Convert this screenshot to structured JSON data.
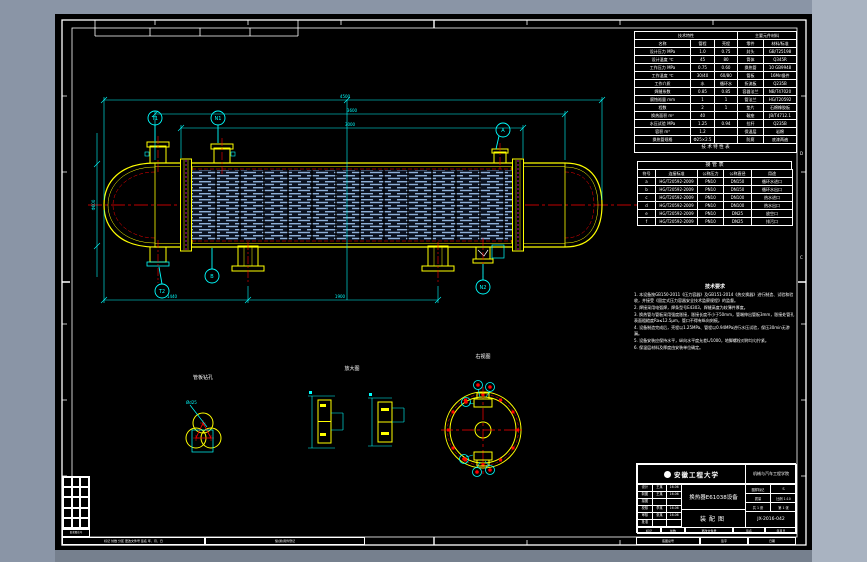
{
  "colors": {
    "background": "#8a95a6",
    "sheet": "#000000",
    "primary_line": "#ffff00",
    "dimension_line": "#00ffff",
    "centerline": "#ff0000",
    "frame_line": "#ffffff",
    "tube_hatch": "#8fb0d8",
    "gasket": "#ff00ff"
  },
  "balloons": [
    {
      "label": "T1"
    },
    {
      "label": "N1"
    },
    {
      "label": "A"
    },
    {
      "label": "B"
    },
    {
      "label": "T2"
    },
    {
      "label": "N2"
    }
  ],
  "dimensions": {
    "overall": "4500",
    "tangent": "3600",
    "tube_length": "3000",
    "saddle_span_a": "1440",
    "saddle_span_b": "1900",
    "diameter": "Φ600",
    "detail_leader": "Ød25"
  },
  "frame": {
    "zone_marks": [
      "D",
      "C"
    ]
  },
  "spec_table": {
    "group_left": "技术特性",
    "group_right": "主要元件材料",
    "headers": [
      "名称",
      "管程",
      "壳程",
      "零件",
      "材料/标准"
    ],
    "rows": [
      [
        "设计压力 MPa",
        "1.0",
        "0.75",
        "封头",
        "GB/T25198"
      ],
      [
        "设计温度 ℃",
        "45",
        "80",
        "筒体",
        "Q345R"
      ],
      [
        "工作压力 MPa",
        "0.75",
        "0.60",
        "换热管",
        "10 GB9948"
      ],
      [
        "工作温度 ℃",
        "30/40",
        "60/80",
        "管板",
        "16Mn锻件"
      ],
      [
        "工作介质",
        "水",
        "循环水",
        "折流板",
        "Q235B"
      ],
      [
        "焊缝系数",
        "0.85",
        "0.85",
        "容器法兰",
        "NB/T47020"
      ],
      [
        "腐蚀裕量 mm",
        "1",
        "1",
        "管法兰",
        "HG/T20592"
      ],
      [
        "程数",
        "2",
        "1",
        "垫片",
        "石棉橡胶板"
      ],
      [
        "换热面积 m²",
        "40",
        "",
        "鞍座",
        "JB/T4712.1"
      ],
      [
        "水压试验 MPa",
        "1.25",
        "0.94",
        "拉杆",
        "Q235B"
      ],
      [
        "容积 m³",
        "1.2",
        "",
        "保温层",
        "岩棉"
      ],
      [
        "换热管规格",
        "Φ25×2.5",
        "",
        "防腐",
        "底漆两遍"
      ]
    ],
    "footer": "技 术 特 性 表"
  },
  "nozzle_table": {
    "title": "接 管 表",
    "headers": [
      "符号",
      "连接标准",
      "公称压力",
      "公称直径",
      "用途"
    ],
    "rows": [
      [
        "a",
        "HG/T20592-2009",
        "PN10",
        "DN150",
        "循环水进口"
      ],
      [
        "b",
        "HG/T20592-2009",
        "PN10",
        "DN150",
        "循环水出口"
      ],
      [
        "c",
        "HG/T20592-2009",
        "PN10",
        "DN100",
        "热水进口"
      ],
      [
        "d",
        "HG/T20592-2009",
        "PN10",
        "DN100",
        "热水出口"
      ],
      [
        "e",
        "HG/T20592-2009",
        "PN10",
        "DN25",
        "放空口"
      ],
      [
        "f",
        "HG/T20592-2009",
        "PN10",
        "DN25",
        "排污口"
      ]
    ]
  },
  "notes": {
    "title": "技术要求",
    "lines": [
      "1. 本设备按GB150-2011《压力容器》及GB151-2014《热交换器》进行制造、试验和验收，并接受《固定式压力容器安全技术监察规程》的监督。",
      "2. 焊接采用电弧焊，焊条型号E4303，焊缝高度为较薄件厚度。",
      "3. 换热管与管板采用强度胀接，胀接长度不小于50mm，管端伸出管板3mm，胀接处管孔表面粗糙度Ra≤12.5μm，管口不得有纵向刻痕。",
      "4. 设备制造完成后，壳程以1.25MPa、管程以0.94MPa进行水压试验，保压30min无渗漏。",
      "5. 设备安装应保持水平，纵向水平度允差L/1000，地脚螺栓对称均匀拧紧。",
      "6. 保温层材料及厚度由安装单位确定。"
    ]
  },
  "details": {
    "tube_layout_label": "管板钻孔",
    "gasket_label": "放大图",
    "end_view_label": "右视图"
  },
  "title_block": {
    "org": "安徽工程大学",
    "dept": "机械与汽车工程学院",
    "drawing_name": "换热器E61038设备",
    "drawing_type": "装配图",
    "roles": [
      [
        "设计",
        "王某",
        "16.06"
      ],
      [
        "制图",
        "王某",
        "16.06"
      ],
      [
        "描图",
        "",
        ""
      ],
      [
        "校核",
        "李某",
        "16.06"
      ],
      [
        "审核",
        "张某",
        "16.06"
      ],
      [
        "批准",
        "",
        ""
      ]
    ],
    "fields": {
      "mark_label": "图样标记",
      "mark_value": "S",
      "mass_label": "质量",
      "scale_label": "比例 1:10",
      "sheets_total": "共 1 张",
      "sheet_no": "第 1 张",
      "code": "JX-2016-042"
    },
    "bottom_cells": [
      "标记",
      "处数",
      "更改文件号",
      "签名",
      "年月日"
    ]
  },
  "margin": {
    "left_cells": [
      "标记 处数 分区 更改文件号 签名 年、月、日",
      "借(通)用件登记"
    ],
    "right_cells": [
      "底图总号",
      "签字",
      "日期"
    ],
    "corner_label": "旧底图总号"
  }
}
